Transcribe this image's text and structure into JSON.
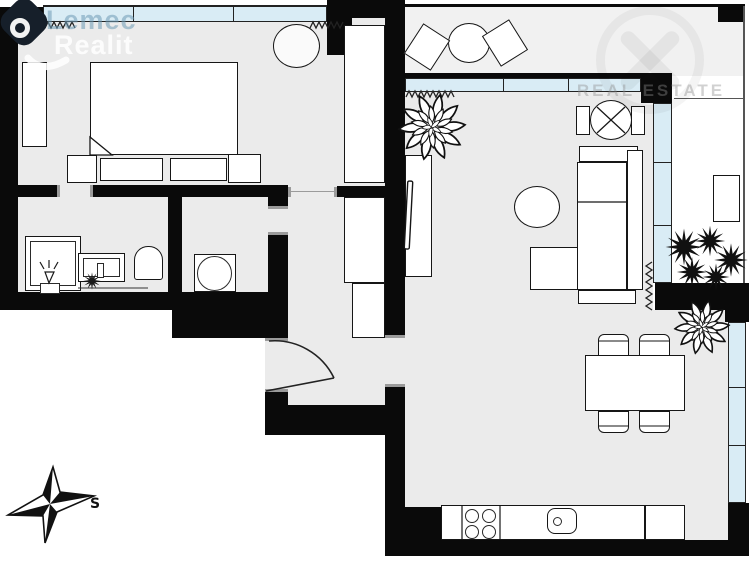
{
  "watermark_left": {
    "line1": "Lemec",
    "line2": "Realit"
  },
  "watermark_right": {
    "text": "REAL ESTATE"
  },
  "compass": {
    "label": "S"
  },
  "colors": {
    "wall": "#0a0a0a",
    "window_glass": "#d9ecf5",
    "floor": "#ebebeb",
    "balcony_floor": "#f1f1f1",
    "furniture": "#ffffff",
    "outline": "#161616",
    "watermark_blue": "rgba(110,155,180,0.55)",
    "watermark_white": "rgba(255,255,255,0.85)"
  }
}
